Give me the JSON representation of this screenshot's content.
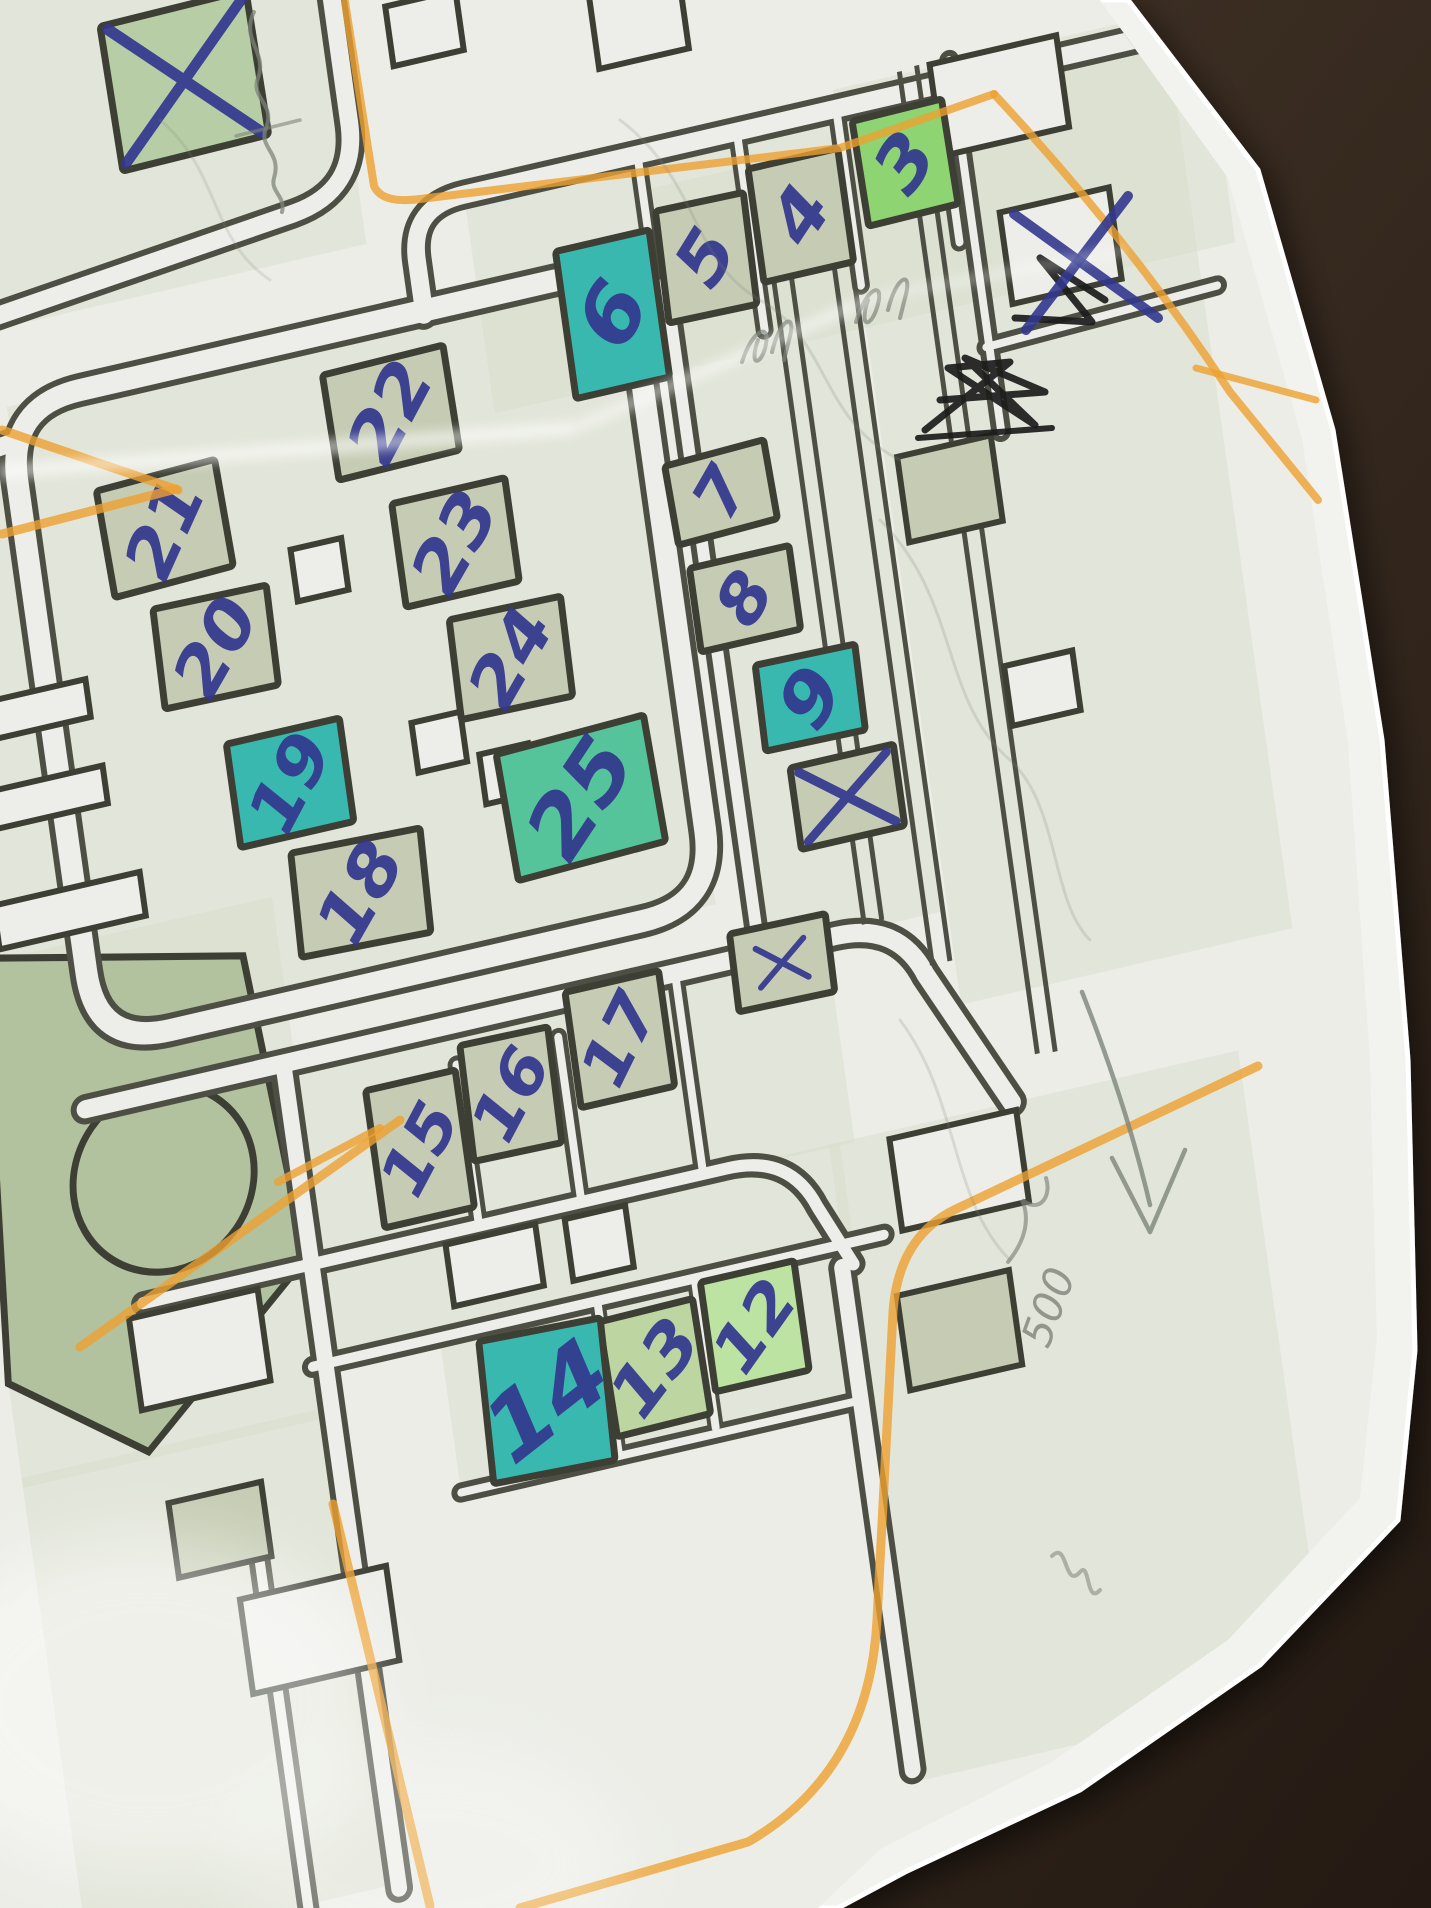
{
  "scene": {
    "width": 1431,
    "height": 1908
  },
  "colors": {
    "leather_light": "#4a3a2c",
    "leather_dark": "#241a13",
    "paper": "#f2f3ee",
    "paper_edge": "#ffffff",
    "map_base": "#ecede7",
    "block_tint": "#d7ddcb",
    "road_dark": "#4e4f44",
    "road_fill": "#edeee9",
    "building_outline": "#3d3f35",
    "sage": "#c6ccb4",
    "sagetint": "#b7cda6",
    "sagegreen": "#bdd5a0",
    "green": "#8ed472",
    "lightgreen": "#bce3a2",
    "teal": "#39b8b0",
    "tealgreen": "#55c49a",
    "park": "#b2c19e",
    "pen_blue": "#32378e",
    "pen_black": "#1b1b1b",
    "pencil": "#7d847a",
    "orange": "#eda030"
  },
  "paper": {
    "points": "0,0 1128,0 1258,170 1333,430 1382,740 1408,1060 1415,1350 1398,1520 1260,1665 1080,1790 905,1872 838,1908 0,1908",
    "map_clip": "0,0 1100,0 1228,178 1302,438 1348,742 1370,1058 1377,1338 1360,1498 1228,1640 1052,1762 882,1848 818,1908 0,1908"
  },
  "map": {
    "transform": "rotate(-13) skewX(-5)",
    "blocks": [
      {
        "x": -50,
        "y": 398,
        "w": 635,
        "h": 644
      },
      {
        "x": 434,
        "y": 294,
        "w": 760,
        "h": 220
      },
      {
        "x": 622,
        "y": 330,
        "w": 190,
        "h": 770
      },
      {
        "x": 815,
        "y": 275,
        "w": 340,
        "h": 920
      },
      {
        "x": -185,
        "y": -80,
        "w": 515,
        "h": 400
      },
      {
        "x": -185,
        "y": 430,
        "w": 130,
        "h": 665
      },
      {
        "x": -70,
        "y": 1100,
        "w": 760,
        "h": 205
      },
      {
        "x": 120,
        "y": 1302,
        "w": 555,
        "h": 102
      },
      {
        "x": 250,
        "y": 1402,
        "w": 415,
        "h": 158
      },
      {
        "x": 664,
        "y": 1302,
        "w": 420,
        "h": 640
      },
      {
        "x": -185,
        "y": 935,
        "w": 330,
        "h": 520
      },
      {
        "x": -185,
        "y": 1445,
        "w": 330,
        "h": 480
      }
    ],
    "roads": [
      {
        "d": "M -50,473 L -50,967 Q -50,1042 25,1042 L 510,1042 Q 585,1042 585,967 L 585,473 Q 585,398 510,398 L 25,398 Q -50,398 -50,473 Z",
        "w": 34,
        "i": 22
      },
      {
        "d": "M 378,402 L 378,348 Q 378,294 434,294 L 1180,294",
        "w": 30,
        "i": 18
      },
      {
        "d": "M -48,434 L -185,448",
        "w": 30,
        "i": 18
      },
      {
        "d": "M 622,424 L 622,1082",
        "w": 24,
        "i": 12
      },
      {
        "d": "M -70,1100 L 700,1100 Q 764,1100 784,1158 L 852,1302",
        "w": 30,
        "i": 18
      },
      {
        "d": "M -40,1302 L 560,1302 Q 624,1302 644,1360 L 672,1424",
        "w": 24,
        "i": 12
      },
      {
        "d": "M 120,1402 L 706,1402",
        "w": 22,
        "i": 10
      },
      {
        "d": "M 133,1104 L 133,1930",
        "w": 28,
        "i": 16
      },
      {
        "d": "M 250,1558 L 664,1558",
        "w": 20,
        "i": 8
      },
      {
        "d": "M 660,1424 L 660,1930",
        "w": 28,
        "i": 16
      },
      {
        "d": "M 330,-70 L 330,198 Q 330,266 262,274 L -185,322",
        "w": 30,
        "i": 18
      },
      {
        "d": "M -95,-80 L -95,244",
        "w": 22,
        "i": 10
      },
      {
        "d": "M 935,272 L 935,646",
        "w": 20,
        "i": 8
      },
      {
        "d": "M 932,560 L 1170,552",
        "w": 20,
        "i": 8
      },
      {
        "d": "M 40,1560 L 40,1930",
        "w": 22,
        "i": 10
      },
      {
        "d": "M 612,302 L 612,506",
        "w": 18,
        "i": 8
      },
      {
        "d": "M 714,298 L 714,494",
        "w": 18,
        "i": 8
      },
      {
        "d": "M 816,294 L 816,472",
        "w": 18,
        "i": 8
      },
      {
        "d": "M 920,288 L 920,452",
        "w": 18,
        "i": 8
      },
      {
        "d": "M 305,1140 L 305,1298",
        "w": 18,
        "i": 8
      },
      {
        "d": "M 410,1136 L 410,1296",
        "w": 18,
        "i": 8
      },
      {
        "d": "M 535,1102 L 535,1300",
        "w": 18,
        "i": 8
      },
      {
        "d": "M 412,1404 L 412,1556",
        "w": 16,
        "i": 8
      },
      {
        "d": "M 512,1404 L 512,1552",
        "w": 16,
        "i": 8
      }
    ],
    "thin_lines": [
      {
        "d": "M 730,336 L 730,1095"
      },
      {
        "d": "M 748,336 L 748,1095"
      },
      {
        "d": "M 792,330 L 792,1150"
      },
      {
        "d": "M 810,330 L 810,1150"
      },
      {
        "d": "M 884,272 L 884,1260"
      },
      {
        "d": "M 902,270 L 902,1262"
      }
    ],
    "park": {
      "points": "-150,930 108,986 128,1295 -55,1448 -185,1350",
      "circle": {
        "cx": -2,
        "cy": 1185,
        "r": 92
      }
    },
    "extra_rects": [
      {
        "x": 418,
        "y": 123,
        "w": 72,
        "h": 60,
        "f": "paper"
      },
      {
        "x": 632,
        "y": 166,
        "w": 92,
        "h": 72,
        "f": "paper"
      },
      {
        "x": 980,
        "y": 318,
        "w": 130,
        "h": 92,
        "f": "paper"
      },
      {
        "x": 1020,
        "y": 478,
        "w": 112,
        "h": 92,
        "f": "paper"
      },
      {
        "x": -75,
        "y": 700,
        "w": 130,
        "h": 38,
        "f": "paper"
      },
      {
        "x": -70,
        "y": 788,
        "w": 130,
        "h": 38,
        "f": "paper"
      },
      {
        "x": -58,
        "y": 903,
        "w": 150,
        "h": 44,
        "f": "paper"
      },
      {
        "x": 10,
        "y": 1360,
        "w": 132,
        "h": 92,
        "f": "paper"
      },
      {
        "x": 90,
        "y": 1660,
        "w": 150,
        "h": 95,
        "f": "paper"
      },
      {
        "x": 315,
        "y": 1344,
        "w": 92,
        "h": 62,
        "f": "paper"
      },
      {
        "x": 422,
        "y": 1346,
        "w": 62,
        "h": 62,
        "f": "paper"
      },
      {
        "x": 790,
        "y": 1356,
        "w": 130,
        "h": 92,
        "f": "paper"
      },
      {
        "x": 333,
        "y": 822,
        "w": 50,
        "h": 50,
        "f": "paper"
      },
      {
        "x": 396,
        "y": 868,
        "w": 50,
        "h": 50,
        "f": "paper"
      },
      {
        "x": 238,
        "y": 627,
        "w": 52,
        "h": 52,
        "f": "paper"
      },
      {
        "x": 940,
        "y": 905,
        "w": 70,
        "h": 60,
        "f": "paper"
      },
      {
        "x": 876,
        "y": 690,
        "w": 96,
        "h": 86,
        "f": "sage"
      },
      {
        "x": 768,
        "y": 1512,
        "w": 115,
        "h": 95,
        "f": "sage"
      },
      {
        "x": 5,
        "y": 1540,
        "w": 95,
        "h": 75,
        "f": "sage"
      }
    ],
    "buildings": [
      {
        "n": "21",
        "x": 90,
        "y": 552,
        "w": 122,
        "h": 108,
        "f": "sage",
        "r": -2,
        "nr": -56,
        "ns": 70
      },
      {
        "n": "20",
        "x": 124,
        "y": 679,
        "w": 116,
        "h": 100,
        "f": "sage",
        "r": 1,
        "nr": -50,
        "ns": 70
      },
      {
        "n": "19",
        "x": 179,
        "y": 828,
        "w": 116,
        "h": 104,
        "f": "teal",
        "r": 0,
        "nr": -52,
        "ns": 70
      },
      {
        "n": "18",
        "x": 234,
        "y": 951,
        "w": 132,
        "h": 104,
        "f": "sage",
        "r": 2,
        "nr": -50,
        "ns": 72
      },
      {
        "n": "22",
        "x": 331,
        "y": 490,
        "w": 124,
        "h": 106,
        "f": "sage",
        "r": -1,
        "nr": -52,
        "ns": 72
      },
      {
        "n": "23",
        "x": 377,
        "y": 631,
        "w": 116,
        "h": 104,
        "f": "sage",
        "r": 0,
        "nr": -50,
        "ns": 72
      },
      {
        "n": "24",
        "x": 416,
        "y": 756,
        "w": 114,
        "h": 100,
        "f": "sage",
        "r": 1,
        "nr": -50,
        "ns": 70
      },
      {
        "n": "25",
        "x": 466,
        "y": 908,
        "w": 152,
        "h": 128,
        "f": "tealgreen",
        "r": -2,
        "nr": -46,
        "ns": 86
      },
      {
        "n": "6",
        "x": 565,
        "y": 444,
        "w": 96,
        "h": 148,
        "f": "teal",
        "r": 0,
        "nr": -50,
        "ns": 84
      },
      {
        "n": "5",
        "x": 666,
        "y": 410,
        "w": 90,
        "h": 112,
        "f": "sage",
        "r": 1,
        "nr": -48,
        "ns": 72
      },
      {
        "n": "4",
        "x": 766,
        "y": 390,
        "w": 92,
        "h": 114,
        "f": "sage",
        "r": 0,
        "nr": -46,
        "ns": 72
      },
      {
        "n": "3",
        "x": 877,
        "y": 362,
        "w": 92,
        "h": 106,
        "f": "green",
        "r": -1,
        "nr": -44,
        "ns": 74
      },
      {
        "n": "7",
        "x": 648,
        "y": 642,
        "w": 102,
        "h": 80,
        "f": "sage",
        "r": -2,
        "nr": -50,
        "ns": 66
      },
      {
        "n": "8",
        "x": 657,
        "y": 751,
        "w": 102,
        "h": 84,
        "f": "sage",
        "r": 0,
        "nr": -48,
        "ns": 68
      },
      {
        "n": "9",
        "x": 708,
        "y": 862,
        "w": 102,
        "h": 86,
        "f": "teal",
        "r": 1,
        "nr": -46,
        "ns": 76
      },
      {
        "n": "12",
        "x": 565,
        "y": 1462,
        "w": 96,
        "h": 110,
        "f": "lightgreen",
        "r": 0,
        "nr": -44,
        "ns": 66
      },
      {
        "n": "13",
        "x": 460,
        "y": 1480,
        "w": 96,
        "h": 116,
        "f": "sagegreen",
        "r": -1,
        "nr": -42,
        "ns": 70
      },
      {
        "n": "14",
        "x": 348,
        "y": 1488,
        "w": 124,
        "h": 142,
        "f": "teal",
        "r": 2,
        "nr": -26,
        "ns": 92
      },
      {
        "n": "15",
        "x": 257,
        "y": 1214,
        "w": 92,
        "h": 138,
        "f": "sage",
        "r": 0,
        "nr": -52,
        "ns": 66
      },
      {
        "n": "16",
        "x": 355,
        "y": 1181,
        "w": 90,
        "h": 116,
        "f": "sage",
        "r": 1,
        "nr": -52,
        "ns": 66
      },
      {
        "n": "17",
        "x": 471,
        "y": 1152,
        "w": 96,
        "h": 116,
        "f": "sage",
        "r": 0,
        "nr": -54,
        "ns": 66
      }
    ],
    "crossed_buildings": [
      {
        "x": 172,
        "y": 120,
        "w": 150,
        "h": 146,
        "f": "sagetint",
        "r": -1,
        "xw": 11,
        "xs": 0.92
      },
      {
        "x": 731,
        "y": 967,
        "w": 106,
        "h": 82,
        "f": "sage",
        "r": 0,
        "xw": 9,
        "xs": 0.85
      },
      {
        "x": 643,
        "y": 1114,
        "w": 98,
        "h": 78,
        "f": "sage",
        "r": 1,
        "xw": 6,
        "xs": 0.5
      }
    ]
  },
  "annotations": {
    "orange_lines": [
      {
        "d": "M 2,430 L 178,490",
        "w": 9
      },
      {
        "d": "M 2,534 L 176,489",
        "w": 9
      },
      {
        "d": "M 345,2 L 374,186 Q 382,204 420,199 L 840,148 L 994,94",
        "w": 8
      },
      {
        "d": "M 994,94 Q 1130,240 1230,392 L 1318,500",
        "w": 8
      },
      {
        "d": "M 1196,368 L 1316,400",
        "w": 7
      },
      {
        "d": "M 1258,1066 L 954,1210 Q 898,1238 893,1312 L 877,1620 Q 869,1772 748,1842 L 520,1908",
        "w": 9
      },
      {
        "d": "M 333,1504 L 430,1906",
        "w": 9
      },
      {
        "d": "M 400,1120 L 80,1347",
        "w": 9
      },
      {
        "d": "M 278,1182 L 380,1128",
        "w": 8
      }
    ],
    "pen_x_marks": [
      {
        "d": "M 1014,214 L 1158,318",
        "w": 10
      },
      {
        "d": "M 1128,196 L 1026,330",
        "w": 10
      }
    ],
    "pen_black_scribbles": [
      {
        "d": "M 1015,318 L 1092,322 L 1040,258 L 1105,300",
        "w": 7
      },
      {
        "d": "M 925,430 L 1010,362 L 948,368 L 1035,425 L 965,358 L 1045,392 L 940,400",
        "w": 7
      },
      {
        "d": "M 918,438 L 1052,428",
        "w": 6
      }
    ],
    "pencil_paths": [
      {
        "d": "M 254,12 C 240,40 268,52 258,78 C 250,98 276,104 266,128 C 258,148 282,152 274,178 C 270,192 286,196 282,212",
        "w": 4,
        "o": 0.75
      },
      {
        "d": "M 236,136 L 300,120",
        "w": 3.5,
        "o": 0.6
      },
      {
        "d": "M 742,362 C 752,330 770,322 766,344 C 762,366 748,368 758,340 M 772,352 C 780,318 796,312 790,336 L 784,360",
        "w": 4,
        "o": 0.7
      },
      {
        "d": "M 856,322 C 866,288 884,280 878,304 C 872,328 858,330 868,300 M 888,310 C 896,276 912,270 906,294 L 900,318",
        "w": 4,
        "o": 0.7
      },
      {
        "d": "M 1082,992 C 1108,1058 1132,1128 1150,1205",
        "w": 4.5,
        "o": 0.8
      },
      {
        "d": "M 1150,1232 L 1112,1158 M 1150,1232 L 1185,1150",
        "w": 4.5,
        "o": 0.8
      },
      {
        "d": "M 1008,1262 C 1026,1240 1030,1218 1022,1200 C 1040,1214 1052,1196 1046,1178",
        "w": 4,
        "o": 0.65
      },
      {
        "d": "M 1052,1556 C 1068,1540 1064,1590 1080,1572 C 1090,1560 1086,1606 1100,1590",
        "w": 4,
        "o": 0.55
      },
      {
        "d": "M 620,120 C 700,180 690,260 760,300 C 830,340 820,420 900,460",
        "w": 3,
        "o": 0.2
      },
      {
        "d": "M 880,520 C 960,600 940,700 1010,760 C 1060,806 1050,900 1090,940",
        "w": 3,
        "o": 0.2
      },
      {
        "d": "M 160,120 C 220,170 210,240 270,280",
        "w": 3,
        "o": 0.18
      },
      {
        "d": "M 900,1020 C 960,1100 950,1200 1010,1260",
        "w": 3,
        "o": 0.2
      }
    ],
    "pencil_note": {
      "text": "500",
      "x": 1062,
      "y": 1312,
      "rot": -70,
      "size": 42
    }
  },
  "creases": [
    {
      "d": "M 0,472 L 575,428",
      "w": 16,
      "o": 0.5
    },
    {
      "d": "M 575,428 L 872,298",
      "w": 13,
      "o": 0.45
    },
    {
      "d": "M 872,298 L 1126,250",
      "w": 10,
      "o": 0.3
    }
  ],
  "flashes": [
    {
      "cx": 150,
      "cy": 1705,
      "rx": 230,
      "ry": 170,
      "o": 0.45
    },
    {
      "cx": 430,
      "cy": 1862,
      "rx": 200,
      "ry": 120,
      "o": 0.3
    }
  ]
}
